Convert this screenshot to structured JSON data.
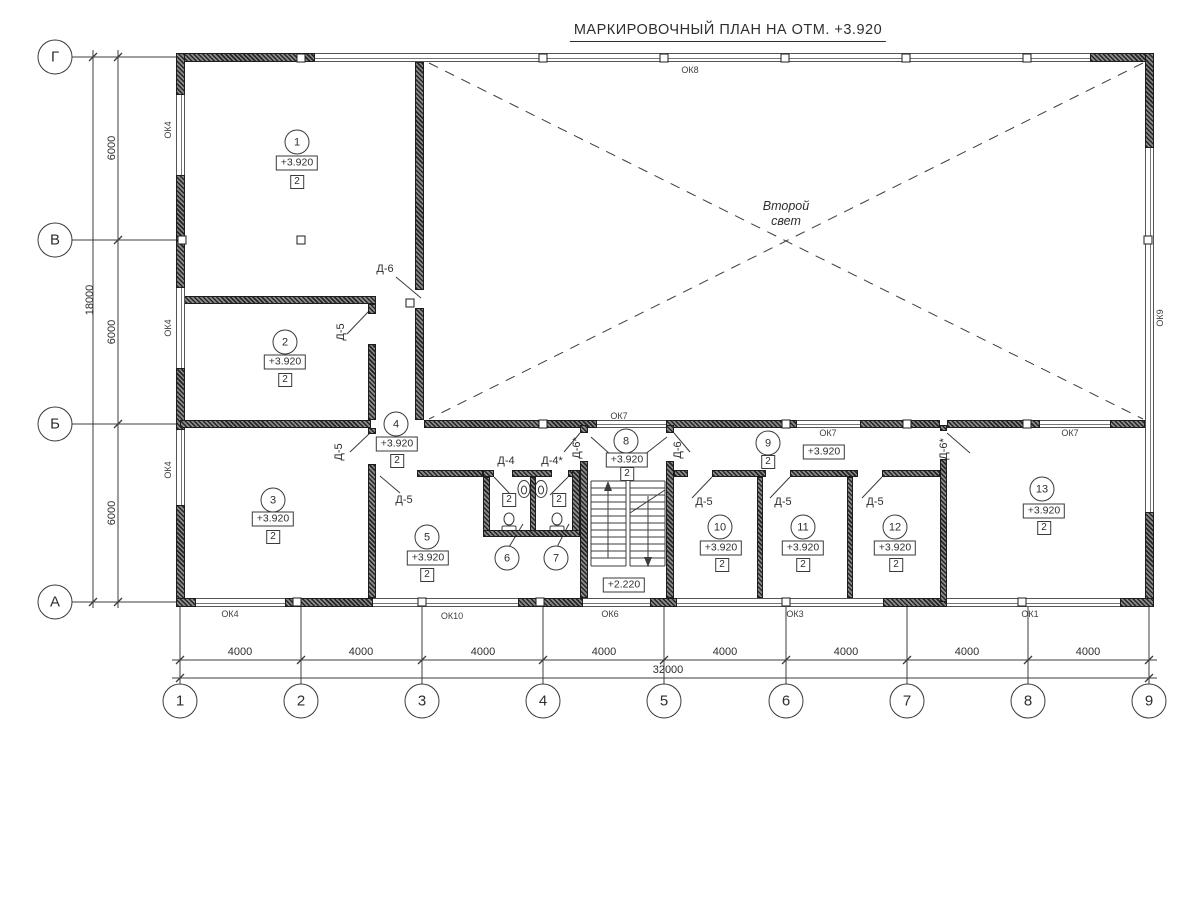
{
  "title": "МАРКИРОВОЧНЫЙ ПЛАН НА ОТМ. +3.920",
  "hall": {
    "line1": "Второй",
    "line2": "свет"
  },
  "stairs": {
    "elevation": "+2.220"
  },
  "axes": {
    "rows": [
      {
        "label": "Г",
        "y": 57
      },
      {
        "label": "В",
        "y": 240
      },
      {
        "label": "Б",
        "y": 424
      },
      {
        "label": "А",
        "y": 602
      }
    ],
    "cols": [
      {
        "label": "1",
        "x": 180
      },
      {
        "label": "2",
        "x": 301
      },
      {
        "label": "3",
        "x": 422
      },
      {
        "label": "4",
        "x": 543
      },
      {
        "label": "5",
        "x": 664
      },
      {
        "label": "6",
        "x": 786
      },
      {
        "label": "7",
        "x": 907
      },
      {
        "label": "8",
        "x": 1028
      },
      {
        "label": "9",
        "x": 1149
      }
    ]
  },
  "dims": {
    "col_segments": [
      {
        "label": "4000",
        "x": 240
      },
      {
        "label": "4000",
        "x": 361
      },
      {
        "label": "4000",
        "x": 483
      },
      {
        "label": "4000",
        "x": 604
      },
      {
        "label": "4000",
        "x": 725
      },
      {
        "label": "4000",
        "x": 846
      },
      {
        "label": "4000",
        "x": 967
      },
      {
        "label": "4000",
        "x": 1088
      }
    ],
    "col_total": "32000",
    "row_segments": [
      {
        "label": "6000",
        "y": 148
      },
      {
        "label": "6000",
        "y": 332
      },
      {
        "label": "6000",
        "y": 513
      }
    ],
    "row_total": "18000"
  },
  "rooms": [
    {
      "number": "1",
      "elevation": "+3.920",
      "category": "2",
      "n": [
        297,
        142
      ],
      "e": [
        297,
        163
      ],
      "c": [
        297,
        182
      ]
    },
    {
      "number": "2",
      "elevation": "+3.920",
      "category": "2",
      "n": [
        285,
        342
      ],
      "e": [
        285,
        362
      ],
      "c": [
        285,
        380
      ]
    },
    {
      "number": "3",
      "elevation": "+3.920",
      "category": "2",
      "n": [
        273,
        500
      ],
      "e": [
        273,
        519
      ],
      "c": [
        273,
        537
      ]
    },
    {
      "number": "4",
      "elevation": "+3.920",
      "category": "2",
      "n": [
        396,
        424
      ],
      "e": [
        397,
        444
      ],
      "c": [
        397,
        461
      ]
    },
    {
      "number": "5",
      "elevation": "+3.920",
      "category": "2",
      "n": [
        427,
        537
      ],
      "e": [
        428,
        558
      ],
      "c": [
        427,
        575
      ]
    },
    {
      "number": "6",
      "category": "2",
      "n": [
        507,
        558
      ],
      "c": [
        509,
        500
      ]
    },
    {
      "number": "7",
      "category": "2",
      "n": [
        556,
        558
      ],
      "c": [
        559,
        500
      ]
    },
    {
      "number": "8",
      "elevation": "+3.920",
      "category": "2",
      "n": [
        626,
        441
      ],
      "e": [
        627,
        460
      ],
      "c": [
        627,
        474
      ]
    },
    {
      "number": "9",
      "elevation": "+3.920",
      "category": "2",
      "n": [
        768,
        443
      ],
      "e": [
        824,
        452
      ],
      "c": [
        768,
        462
      ]
    },
    {
      "number": "10",
      "elevation": "+3.920",
      "category": "2",
      "n": [
        720,
        527
      ],
      "e": [
        721,
        548
      ],
      "c": [
        722,
        565
      ]
    },
    {
      "number": "11",
      "elevation": "+3.920",
      "category": "2",
      "n": [
        803,
        527
      ],
      "e": [
        803,
        548
      ],
      "c": [
        803,
        565
      ]
    },
    {
      "number": "12",
      "elevation": "+3.920",
      "category": "2",
      "n": [
        895,
        527
      ],
      "e": [
        895,
        548
      ],
      "c": [
        896,
        565
      ]
    },
    {
      "number": "13",
      "elevation": "+3.920",
      "category": "2",
      "n": [
        1042,
        489
      ],
      "e": [
        1044,
        511
      ],
      "c": [
        1044,
        528
      ]
    }
  ],
  "doors": [
    {
      "label": "Д-6",
      "x": 385,
      "y": 269,
      "v": false
    },
    {
      "label": "Д-5",
      "x": 341,
      "y": 332,
      "v": true
    },
    {
      "label": "Д-5",
      "x": 339,
      "y": 452,
      "v": true
    },
    {
      "label": "Д-5",
      "x": 404,
      "y": 500,
      "v": false
    },
    {
      "label": "Д-4",
      "x": 506,
      "y": 461,
      "v": false
    },
    {
      "label": "Д-4*",
      "x": 552,
      "y": 461,
      "v": false
    },
    {
      "label": "Д-6*",
      "x": 577,
      "y": 448,
      "v": true
    },
    {
      "label": "Д-6",
      "x": 678,
      "y": 450,
      "v": true
    },
    {
      "label": "Д-5",
      "x": 704,
      "y": 502,
      "v": false
    },
    {
      "label": "Д-5",
      "x": 783,
      "y": 502,
      "v": false
    },
    {
      "label": "Д-5",
      "x": 875,
      "y": 502,
      "v": false
    },
    {
      "label": "Д-6*",
      "x": 944,
      "y": 449,
      "v": true
    }
  ],
  "windows": [
    {
      "label": "ОК4",
      "x": 168,
      "y": 130,
      "v": true
    },
    {
      "label": "ОК4",
      "x": 168,
      "y": 328,
      "v": true
    },
    {
      "label": "ОК4",
      "x": 168,
      "y": 470,
      "v": true
    },
    {
      "label": "ОК8",
      "x": 690,
      "y": 70,
      "v": false
    },
    {
      "label": "ОК9",
      "x": 1160,
      "y": 318,
      "v": true
    },
    {
      "label": "ОК7",
      "x": 619,
      "y": 416,
      "v": false
    },
    {
      "label": "ОК7",
      "x": 828,
      "y": 433,
      "v": false
    },
    {
      "label": "ОК7",
      "x": 1070,
      "y": 433,
      "v": false
    },
    {
      "label": "ОК4",
      "x": 230,
      "y": 614,
      "v": false
    },
    {
      "label": "ОК10",
      "x": 452,
      "y": 616,
      "v": false
    },
    {
      "label": "ОК6",
      "x": 610,
      "y": 614,
      "v": false
    },
    {
      "label": "ОК3",
      "x": 795,
      "y": 614,
      "v": false
    },
    {
      "label": "ОК1",
      "x": 1030,
      "y": 614,
      "v": false
    }
  ]
}
